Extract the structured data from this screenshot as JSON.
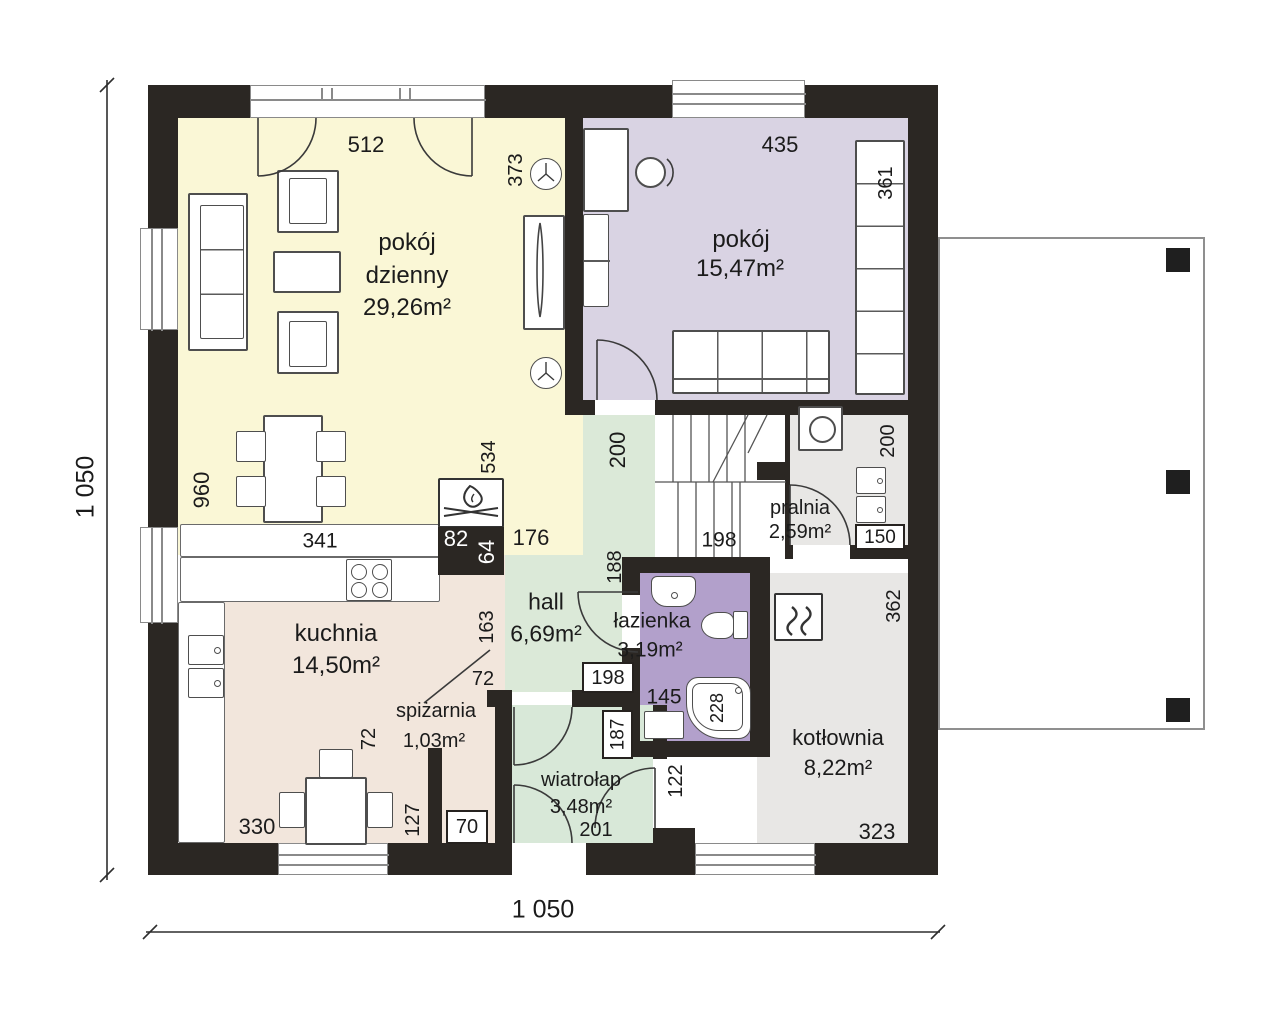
{
  "overall": {
    "width_label": "1 050",
    "height_label": "1 050"
  },
  "rooms": {
    "living": {
      "line1": "pokój",
      "line2": "dzienny",
      "area": "29,26m²"
    },
    "bedroom": {
      "name": "pokój",
      "area": "15,47m²"
    },
    "laundry": {
      "name": "pralnia",
      "area": "2,59m²"
    },
    "hall": {
      "name": "hall",
      "area": "6,69m²"
    },
    "bathroom": {
      "name": "łazienka",
      "area": "3,19m²"
    },
    "kitchen": {
      "name": "kuchnia",
      "area": "14,50m²"
    },
    "pantry": {
      "name": "spiżarnia",
      "area": "1,03m²"
    },
    "vestibule": {
      "name": "wiatrołap",
      "area": "3,48m²"
    },
    "boiler": {
      "name": "kotłownia",
      "area": "8,22m²"
    }
  },
  "dims": {
    "living_top": "512",
    "living_wall": "373",
    "bedroom_top": "435",
    "wardrobe": "361",
    "living_left": "960",
    "counter": "341",
    "chimney_h": "534",
    "chimney_w1": "82",
    "chimney_w2": "64",
    "hall_top": "176",
    "stair_width": "200",
    "stair_run": "198",
    "laundry_right": "200",
    "laundry_door": "150",
    "hall_mid": "188",
    "kitchen_right": "163",
    "hall_door": "198",
    "pantry_w": "72",
    "pantry_h": "72",
    "pantry_inner": "127",
    "pantry_door": "70",
    "kitchen_bottom": "330",
    "vest_door": "187",
    "vest_right": "122",
    "bath_w": "145",
    "bath_tub": "228",
    "vest_bottom": "201",
    "boiler_right": "362",
    "boiler_bottom": "323"
  },
  "icons": {
    "fireplace": "campfire-icon",
    "boiler": "heat-waves-icon",
    "lamp": "ceiling-lamp-icon"
  },
  "colors": {
    "wall": "#2b2723",
    "living": "#faf7d6",
    "bedroom": "#d9d3e3",
    "hall": "#dbe9d8",
    "vestibule": "#d8e8d8",
    "kitchen": "#f2e6dc",
    "laundry": "#e8e7e5",
    "boiler_room": "#e8e7e5",
    "bathroom": "#b2a0cb",
    "terrace_border": "#8f8f8f"
  }
}
